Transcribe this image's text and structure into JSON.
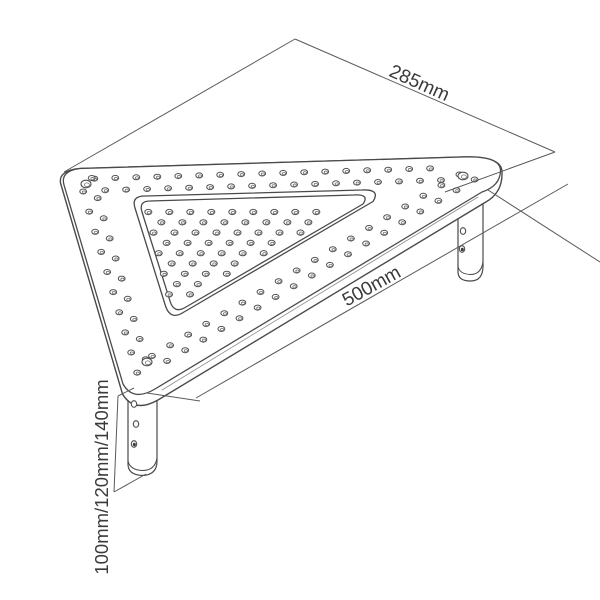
{
  "colors": {
    "background": "#ffffff",
    "line": "#4a4a4a",
    "hole_line": "#4f4f4f",
    "hole_inner_line": "#777777",
    "dim_line": "#5a5a5a",
    "text": "#3a3a3a",
    "accent_edge": "#8a8a8a",
    "hole_dark_fill": "#3a3a3a"
  },
  "labels": {
    "back_edge": {
      "text": "285mm"
    },
    "front_edge": {
      "text": "500mm"
    },
    "leg_heights": {
      "text": "100mm/120mm/140mm"
    }
  },
  "drawing": {
    "canvas": {
      "w": 600,
      "h": 600
    },
    "paths": [
      {
        "n": "leg-right-body",
        "d": "M458 201 L458 272 Q458 281 470.5 281 Q483 281 483 266 L483 194",
        "f": "#ffffff",
        "w": 1.2
      },
      {
        "n": "leg-right-foot-rim",
        "d": "M458 266 Q459 274 470.5 274.5 Q481 274.5 483 262",
        "f": "none",
        "w": 1
      },
      {
        "n": "leg-front-body",
        "d": "M128 387 L128 464 Q128 475 142.5 475.5 Q157 475 157 461 L157 393",
        "f": "#ffffff",
        "w": 1.2
      },
      {
        "n": "leg-front-foot-rim",
        "d": "M128 461 Q130 470 142.5 470.5 Q155 470.5 157 458",
        "f": "none",
        "w": 1
      },
      {
        "n": "platform-side",
        "d": "M80 168.5 L462 157 Q503 155.5 502 173 Q502.5 193 485 202.5 L158 400 Q134 413.5 122.5 394 L60.5 183 Q58.5 170.5 80 168.5 Z",
        "f": "#ffffff",
        "w": 1.4
      },
      {
        "n": "platform-top",
        "d": "M80 168.5 L462 157 Q501 155.5 500.5 171 Q500 186 482 192 L155 389 Q133 402 123 384 L64 185 Q60 171 80 168.5 Z",
        "f": "#ffffff",
        "w": 1.3
      },
      {
        "n": "front-edge-accent",
        "d": "M162 390 L478 197",
        "f": "none",
        "w": 0.8,
        "s": "#8a8a8a"
      },
      {
        "n": "tray-groove-outer",
        "d": "M146 196 L362 190 Q381 189 373 201.5 L184 312 Q170.5 321 165.5 306 L135 208 Q131 195.5 146 196 Z",
        "f": "none",
        "w": 1.3
      },
      {
        "n": "tray-groove-inner",
        "d": "M150 201 L354 195 Q370 194 363 204 L186 307 Q174 314.5 170 301 L142 212 Q138.5 201 150 201 Z",
        "f": "none",
        "w": 1.3
      }
    ],
    "dim_lines": [
      {
        "n": "ext-285-left",
        "p": [
          295,
          39,
          64,
          172
        ]
      },
      {
        "n": "dim-285",
        "p": [
          295,
          39,
          555,
          152
        ]
      },
      {
        "n": "ext-285-right",
        "p": [
          555,
          152,
          445,
          192
        ]
      },
      {
        "n": "dim-500",
        "p": [
          568,
          184,
          196,
          398
        ]
      },
      {
        "n": "ext-500-right",
        "p": [
          488,
          190,
          600,
          262
        ]
      },
      {
        "n": "ext-500-left",
        "p": [
          147,
          393,
          200,
          401
        ]
      },
      {
        "n": "leg-dim-tick-top",
        "p": [
          118,
          396,
          134,
          388
        ]
      },
      {
        "n": "leg-dim-vertical",
        "p": [
          118,
          396,
          114,
          492
        ]
      },
      {
        "n": "leg-dim-tick-bottom",
        "p": [
          114,
          492,
          146,
          474
        ]
      }
    ],
    "holes": {
      "inner_grid": {
        "y0": 212,
        "y1": 306,
        "row_step": 10.3,
        "x_step": 21,
        "stagger": 10.5,
        "margin": 5,
        "left": {
          "x0": 141,
          "y0": 203,
          "dxdy": 0.252
        },
        "right": {
          "x0": 366,
          "y0": 197,
          "dxdy": -1.7
        },
        "rx": 3.5,
        "ry": 2.6
      },
      "rings": [
        {
          "ax": 80,
          "ay": 169,
          "bx": 460,
          "by": 157.5,
          "insets": [
            10,
            22
          ],
          "step": 21,
          "m0": 14,
          "m1": 12
        },
        {
          "ax": 490,
          "ay": 182,
          "bx": 146,
          "by": 385,
          "insets": [
            10,
            22
          ],
          "step": 21,
          "m0": 12,
          "m1": 16
        },
        {
          "ax": 131,
          "ay": 387,
          "bx": 67,
          "by": 172,
          "insets": [
            10,
            22
          ],
          "step": 21,
          "m0": 12,
          "m1": 12
        }
      ],
      "ring_rx": 3.4,
      "ring_ry": 2.5,
      "big": [
        [
          86,
          184
        ],
        [
          463,
          176
        ],
        [
          147,
          362
        ]
      ],
      "big_rx": 5,
      "big_ry": 3.8,
      "leg": [
        [
          463,
          231,
          0
        ],
        [
          462,
          249,
          1
        ],
        [
          134,
          404,
          0
        ],
        [
          136,
          424,
          0
        ],
        [
          134,
          444,
          1
        ]
      ],
      "leg_rx": 2.7,
      "leg_ry": 3.3
    }
  }
}
